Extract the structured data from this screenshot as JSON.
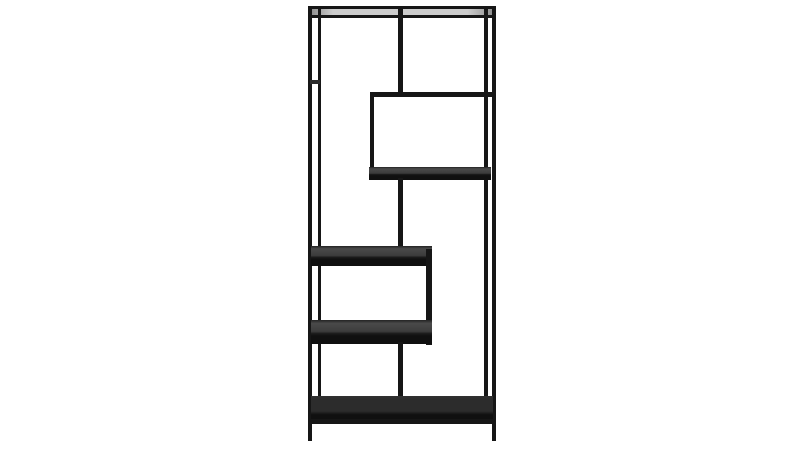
{
  "scene": {
    "description": "Product photo of a tall black metal etagere bookcase with asymmetric open shelves, centered on a plain white background",
    "shelf_count": 6,
    "palette": {
      "background": "#ffffff",
      "frame": "#161616",
      "joint": "#2a2a2a",
      "shelf_surface_top": "#4a4a4a",
      "shelf_surface_mid": "#3c3c3c",
      "shelf_front_edge": "#101010",
      "bottom_shelf_surface": "#2c2c2c",
      "top_reflection_light": "#cccccc",
      "top_reflection_dark": "#8f8f8f"
    }
  },
  "furniture": {
    "name": "asymmetric-etagere-bookcase",
    "parts": [
      {
        "name": "top-rail",
        "kind": "tube",
        "x": 308,
        "y": 6,
        "w": 188,
        "h": 4
      },
      {
        "name": "top-shelf-surface",
        "kind": "top-surface",
        "x": 311,
        "y": 9,
        "w": 182,
        "h": 7
      },
      {
        "name": "top-front-edge",
        "kind": "tube",
        "x": 308,
        "y": 15,
        "w": 188,
        "h": 3
      },
      {
        "name": "left-back-leg",
        "kind": "tube",
        "x": 318,
        "y": 9,
        "w": 3,
        "h": 391
      },
      {
        "name": "right-back-leg",
        "kind": "tube",
        "x": 484,
        "y": 9,
        "w": 4,
        "h": 391
      },
      {
        "name": "left-front-leg",
        "kind": "tube",
        "x": 308,
        "y": 7,
        "w": 4,
        "h": 434
      },
      {
        "name": "right-front-leg",
        "kind": "tube",
        "x": 492,
        "y": 7,
        "w": 4,
        "h": 434
      },
      {
        "name": "left-post-joint",
        "kind": "joint",
        "x": 310,
        "y": 80,
        "w": 10,
        "h": 4
      },
      {
        "name": "top-center-divider",
        "kind": "tube",
        "x": 398,
        "y": 9,
        "w": 5,
        "h": 86
      },
      {
        "name": "box-top-rail",
        "kind": "tube",
        "x": 370,
        "y": 92,
        "w": 122,
        "h": 5
      },
      {
        "name": "box-left-post",
        "kind": "tube",
        "x": 370,
        "y": 94,
        "w": 4,
        "h": 82
      },
      {
        "name": "box-bottom-shelf",
        "kind": "shelf",
        "x": 369,
        "y": 167,
        "w": 122,
        "h": 13
      },
      {
        "name": "mid-divider-upper",
        "kind": "tube",
        "x": 398,
        "y": 178,
        "w": 5,
        "h": 70
      },
      {
        "name": "middle-shelf-upper",
        "kind": "shelf",
        "x": 311,
        "y": 246,
        "w": 121,
        "h": 20
      },
      {
        "name": "shelf-connector-post",
        "kind": "tube",
        "x": 426,
        "y": 249,
        "w": 6,
        "h": 96
      },
      {
        "name": "middle-shelf-lower",
        "kind": "shelf",
        "x": 311,
        "y": 320,
        "w": 121,
        "h": 24
      },
      {
        "name": "mid-divider-lower",
        "kind": "tube",
        "x": 398,
        "y": 342,
        "w": 5,
        "h": 58
      },
      {
        "name": "bottom-shelf",
        "kind": "shelf-dark",
        "x": 311,
        "y": 396,
        "w": 182,
        "h": 26
      },
      {
        "name": "bottom-rail",
        "kind": "tube",
        "x": 308,
        "y": 419,
        "w": 188,
        "h": 5
      }
    ]
  }
}
